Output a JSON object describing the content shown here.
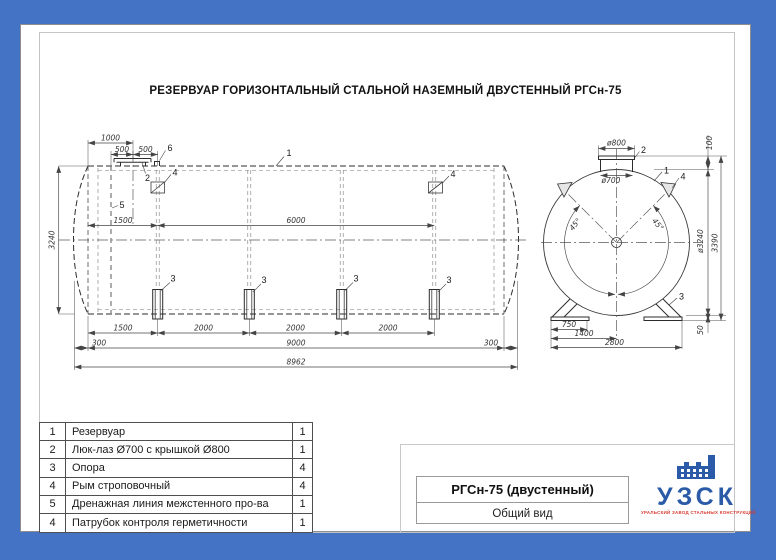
{
  "sheet": {
    "title": "РЕЗЕРВУАР ГОРИЗОНТАЛЬНЫЙ СТАЛЬНОЙ НАЗЕМНЫЙ ДВУСТЕННЫЙ РГСн-75"
  },
  "dims": {
    "d1000": "1000",
    "d500": "500",
    "d1500": "1500",
    "d6000": "6000",
    "d3240": "3240",
    "d2000": "2000",
    "d300": "300",
    "d9000": "9000",
    "d8962": "8962",
    "d800": "ø800",
    "d700": "ø700",
    "d100": "100",
    "dd3240": "ø3240",
    "d3390": "3390",
    "d45": "45°",
    "d750": "750",
    "d1400": "1400",
    "d2800": "2800",
    "d50": "50"
  },
  "callouts": {
    "c1": "1",
    "c2": "2",
    "c3": "3",
    "c4": "4",
    "c5": "5",
    "c6": "6"
  },
  "parts_table": {
    "rows": [
      {
        "pos": "1",
        "name": "Резервуар",
        "qty": "1"
      },
      {
        "pos": "2",
        "name": "Люк-лаз Ø700 с крышкой Ø800",
        "qty": "1"
      },
      {
        "pos": "3",
        "name": "Опора",
        "qty": "4"
      },
      {
        "pos": "4",
        "name": "Рым строповочный",
        "qty": "4"
      },
      {
        "pos": "5",
        "name": "Дренажная линия межстенного про-ва",
        "qty": "1"
      },
      {
        "pos": "4",
        "name": "Патрубок контроля герметичности",
        "qty": "1"
      }
    ]
  },
  "title_block": {
    "model": "РГСн-75 (двустенный)",
    "view_name": "Общий вид"
  },
  "logo": {
    "abbr": "УЗСК",
    "subtitle": "УРАЛЬСКИЙ ЗАВОД СТАЛЬНЫХ КОНСТРУКЦИЙ"
  }
}
